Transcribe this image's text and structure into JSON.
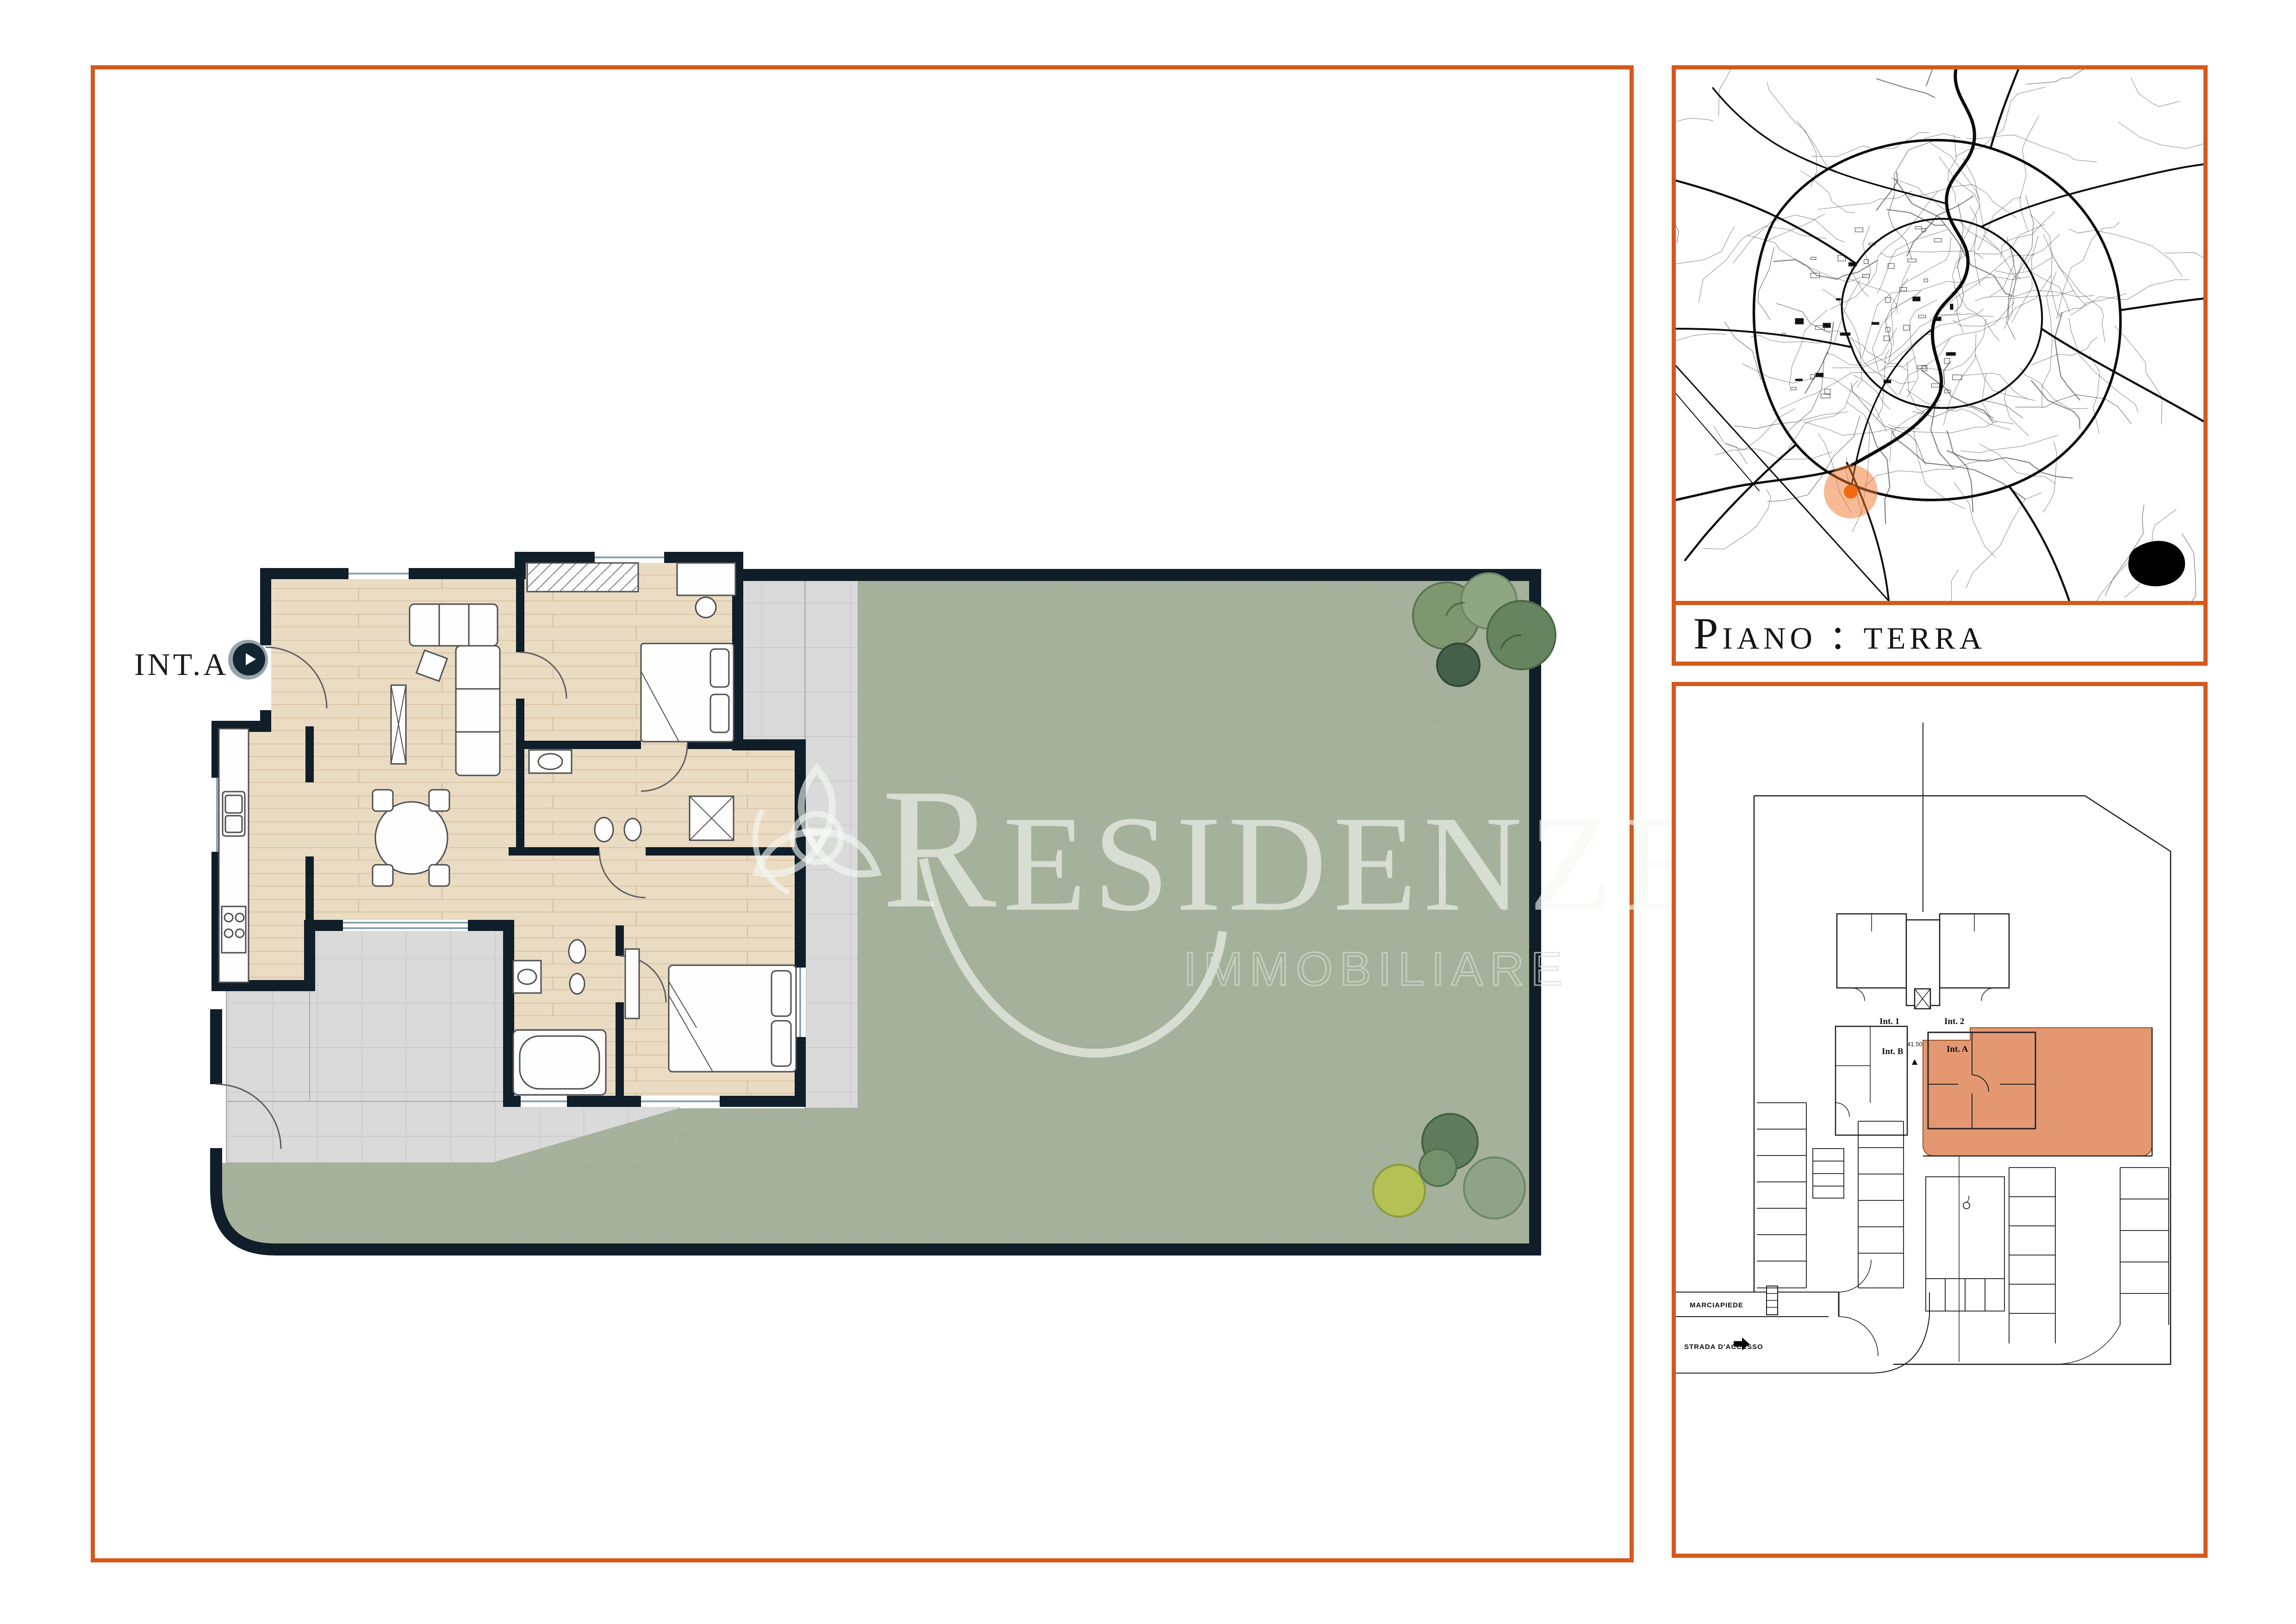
{
  "page": {
    "background": "#FFFFFF",
    "type": "real-estate floor plan sheet"
  },
  "colors": {
    "accent_border": "#D4591B",
    "wall": "#0F1E28",
    "garden_green": "#A6B29B",
    "terrace_grey": "#DADADA",
    "wood_floor": "#EADBC3",
    "unit_highlight": "#E08A5E",
    "map_marker": "#F26A10",
    "map_marker_halo": "rgba(242,116,44,0.5)",
    "watermark": "rgba(246,248,244,0.62)"
  },
  "main_panel": {
    "unit": {
      "label": "INT.A"
    },
    "tour_button_icon": "play-icon",
    "watermark": {
      "initial": "R",
      "rest": "ESIDENZE",
      "subtitle": "IMMOBILIARE",
      "logo_icon": "triquetra-logo-icon"
    }
  },
  "map_panel": {
    "description": "city street map",
    "marker_icon": "location-marker",
    "lake_icon": "lake-shape"
  },
  "floor_banner": {
    "label": "Piano : terra"
  },
  "site_panel": {
    "unit_labels": [
      {
        "label": "Int. 1"
      },
      {
        "label": "Int. 2"
      },
      {
        "label": "Int. A"
      },
      {
        "label": "Int. B"
      }
    ],
    "elevation_label": "41.50",
    "street_labels": {
      "sidewalk": "MARCIAPIEDE",
      "access_road": "STRADA D'ACCESSO"
    },
    "access_arrow_icon": "arrow-right-icon",
    "entrance_arrow_icon": "arrow-up-icon"
  }
}
